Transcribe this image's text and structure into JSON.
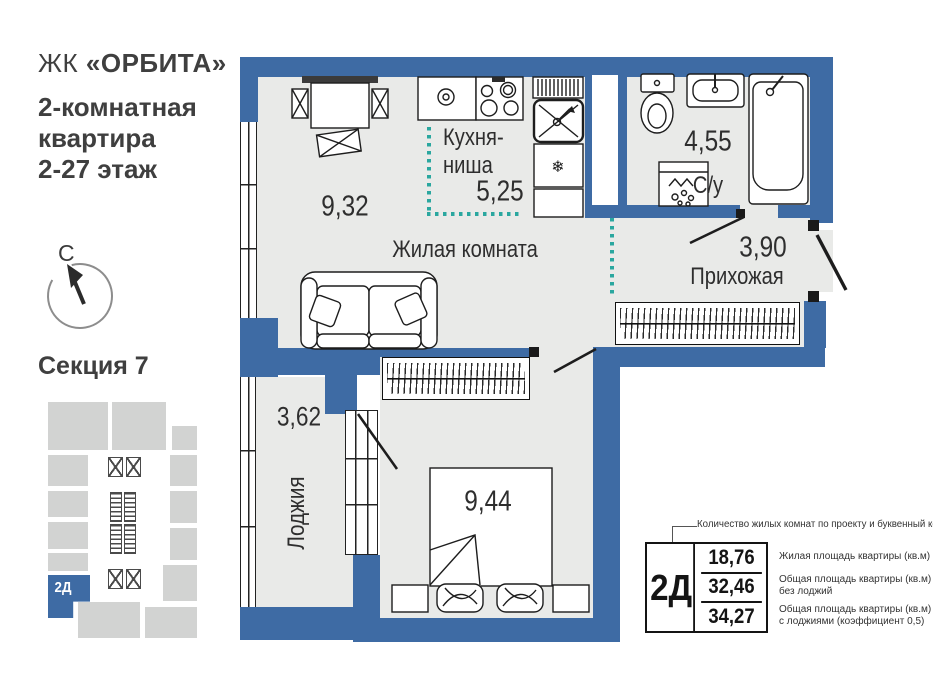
{
  "panel": {
    "logo_prefix": "ЖК ",
    "logo_name": "«ОРБИТА»",
    "subtitle": "2-комнатная\nквартира\n2-27 этаж",
    "compass_letter": "С",
    "section_label": "Секция 7",
    "minimap_unit_code": "2Д"
  },
  "plan": {
    "rooms": {
      "living": {
        "label": "Жилая комната",
        "area": "9,32"
      },
      "kitchen": {
        "label": "Кухня-\nниша",
        "area": "5,25"
      },
      "bathroom": {
        "label": "С/у",
        "area": "4,55"
      },
      "hallway": {
        "label": "Прихожая",
        "area": "3,90"
      },
      "loggia": {
        "label": "Лоджия",
        "area": "3,62"
      },
      "bedroom": {
        "area": "9,44"
      }
    }
  },
  "legend": {
    "annotation": "Количество жилых комнат по проекту и буквенный код",
    "unit_code": "2Д",
    "rows": [
      {
        "value": "18,76",
        "desc": "Жилая площадь квартиры (кв.м)"
      },
      {
        "value": "32,46",
        "desc": "Общая площадь квартиры (кв.м)\nбез лоджий"
      },
      {
        "value": "34,27",
        "desc": "Общая площадь квартиры (кв.м)\nс лоджиями (коэффициент 0,5)"
      }
    ]
  },
  "colors": {
    "wall_blue": "#3e6ba4",
    "niche_teal": "#2aa79f",
    "floor_gray": "#e9eae8",
    "minimap_gray": "#d2d3d2"
  }
}
